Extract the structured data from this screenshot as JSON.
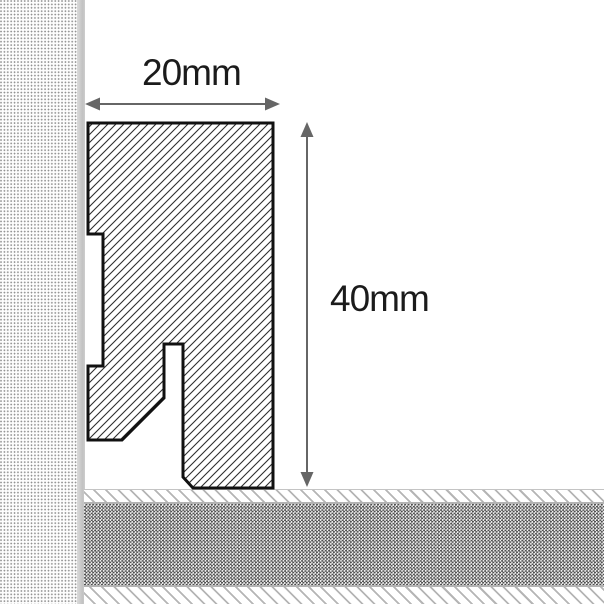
{
  "diagram": {
    "type": "skirting-board cross-section drawing",
    "labels": {
      "width": "20mm",
      "height": "40mm"
    },
    "colors": {
      "profile_outline": "#111111",
      "profile_hatch_line": "#2e2e2e",
      "dimension_arrow": "#666666",
      "label_text": "#1b1b1b",
      "wall_edge": "#c6c6c6",
      "wall_stipple_dot": "#8f8f8f",
      "floor_hatch_line": "#b5b5b5",
      "floor_core_checker": "#4e4e4e",
      "background": "#ffffff"
    }
  }
}
